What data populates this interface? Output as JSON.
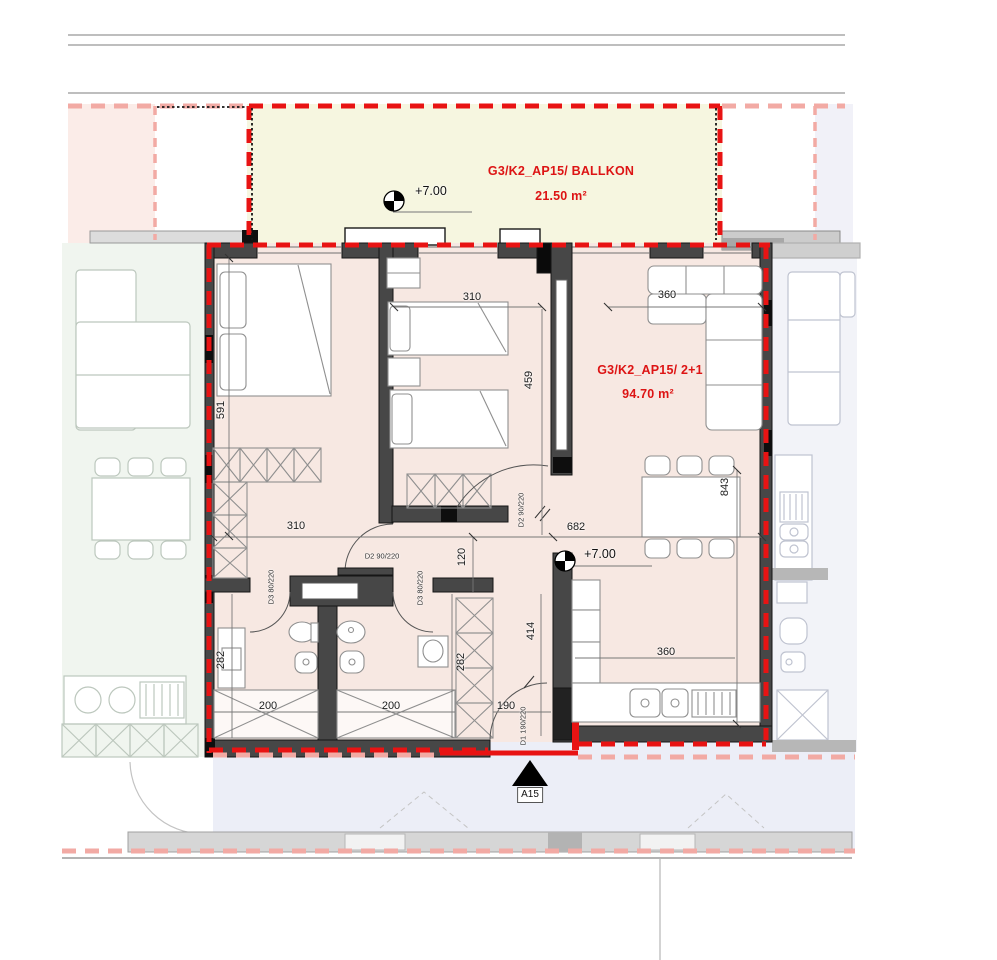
{
  "plan": {
    "balcony": {
      "title": "G3/K2_AP15/ BALLKON",
      "area": "21.50 m²",
      "elevation": "+7.00"
    },
    "apartment": {
      "title": "G3/K2_AP15/ 2+1",
      "area": "94.70 m²",
      "elevation": "+7.00"
    },
    "section_marker": "A15",
    "dimensions": {
      "bedroom1_depth": "591",
      "bedroom2_width": "310",
      "living_top_width": "360",
      "bedroom2_depth": "459",
      "living_depth": "843",
      "hall_width": "310",
      "living_width": "682",
      "hall_height": "120",
      "bath1_depth": "282",
      "bath2_depth": "282",
      "bath1_width": "200",
      "bath2_width": "200",
      "entry_width": "190",
      "kitchen_depth": "414",
      "kitchen_width": "360"
    },
    "doors": {
      "d2_bedroom1": "D2 90/220",
      "d2_bedroom2": "D2 90/220",
      "d3_bath1": "D3 80/220",
      "d3_bath2": "D3 80/220",
      "d1_entry": "D1 190/220"
    },
    "colors": {
      "boundary_red": "#e81313",
      "faded_red": "#f2aaa4",
      "apartment_fill": "#f7e8e2",
      "balcony_fill": "#f6f6e0",
      "wall": "#474747"
    }
  }
}
